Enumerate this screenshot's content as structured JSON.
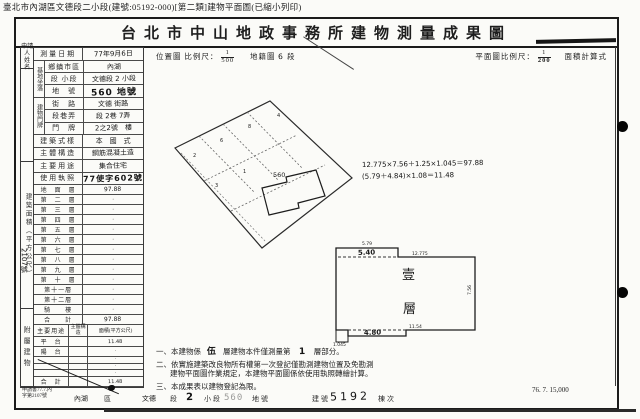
{
  "file_header": "臺北市內湖區文德段二小段(建號:05192-000)[第二類]建物平面圖(已縮小列印)",
  "title": "台北市中山地政事務所建物測量成果圖",
  "left_form": {
    "applicant_line1": "申請人",
    "applicant_line2": "姓 名",
    "building_area_axis": "建築面積（平方公尺）",
    "annex_axis": "附屬建物",
    "serial_hand": "2107號",
    "survey": {
      "label": "測量日期",
      "value": "77年9月6日"
    },
    "site": {
      "axis": "基地坐落",
      "rows": [
        {
          "label": "鄉鎮市區",
          "value": "內湖"
        },
        {
          "label": "段 小段",
          "value": "文德段 2 小段"
        },
        {
          "label": "地　號",
          "value": "560 地號"
        }
      ]
    },
    "address": {
      "axis": "建物門牌",
      "rows": [
        {
          "label": "街　路",
          "value": "文德 街路"
        },
        {
          "label": "段巷弄",
          "value": "段 2巷 7弄"
        },
        {
          "label": "門　牌",
          "value": "2之2號　樓"
        }
      ]
    },
    "style": {
      "label": "建築式樣",
      "value": "本　國　式"
    },
    "structure": {
      "label": "主體構造",
      "value": "鋼筋混凝土造"
    },
    "usage": {
      "label": "主要用途",
      "value": "集合住宅"
    },
    "license": {
      "label": "使用執照",
      "value": "77使字602號"
    },
    "floors": [
      {
        "label": "地　面　層",
        "value": "97.88"
      },
      {
        "label": "第　二　層",
        "value": "·"
      },
      {
        "label": "第　三　層",
        "value": "·"
      },
      {
        "label": "第　四　層",
        "value": "·"
      },
      {
        "label": "第　五　層",
        "value": "·"
      },
      {
        "label": "第　六　層",
        "value": "·"
      },
      {
        "label": "第　七　層",
        "value": "·"
      },
      {
        "label": "第　八　層",
        "value": "·"
      },
      {
        "label": "第　九　層",
        "value": "·"
      },
      {
        "label": "第　十　層",
        "value": "·"
      },
      {
        "label": "第十一層",
        "value": "·"
      },
      {
        "label": "第十二層",
        "value": "·"
      },
      {
        "label": "騎　　樓",
        "value": "·"
      },
      {
        "label": "合　　計",
        "value": "97.88"
      }
    ],
    "annex": {
      "headers": [
        "主要用途",
        "主體構造",
        "面積(平方公尺)"
      ],
      "rows": [
        {
          "use": "平　台",
          "area": "11.48"
        },
        {
          "use": "陽　台",
          "area": "·"
        },
        {
          "use": "",
          "area": "·"
        },
        {
          "use": "",
          "area": "·"
        },
        {
          "use": "",
          "area": "·"
        }
      ],
      "total_label": "合　計",
      "total": "11.48"
    },
    "application_line1": "申請書77.7.內",
    "application_line2": "字第2107號"
  },
  "map": {
    "location_label": "位置圖 比例尺：",
    "location_num": "1",
    "location_den": "500",
    "cadastral_label": "地籍圖",
    "cadastral_hand": "6",
    "cadastral_suffix": "段",
    "plan_label": "平面圖比例尺：",
    "plan_num": "1",
    "plan_den": "200",
    "calc_label": "面積計算式",
    "formula_main": "12.775×7.56＋1.25×1.045＝97.88",
    "formula_annex": "(5.79＋4.84)×1.08＝11.48",
    "parcel_number": "560",
    "floor_char_top": "壹",
    "floor_char_bottom": "層",
    "parcel_digits": [
      "2",
      "6",
      "8",
      "4",
      "3",
      "1"
    ],
    "dims": {
      "top_balcony": "5.40",
      "top_balcony_small": "5.79",
      "top_edge": "12.775",
      "right_edge": "7.56",
      "bottom_balcony": "4.80",
      "corner": "1.045",
      "bottom_edge": "11.54"
    }
  },
  "notes": {
    "n1_pre": "一、本建物係",
    "n1_hand1": "伍",
    "n1_mid": "層建物本件僅測量第",
    "n1_hand2": "1",
    "n1_suf": "層部分。",
    "n2_line1": "二、依實施建築改良物所有權第一次登記僅勘測建物位置及免勘測",
    "n2_line2": "建物平面圖作業規定，本建物平面圖係依使用執照轉繪計算。",
    "n3": "三、本成果表以建物登記為限。"
  },
  "footer": {
    "district": "內湖",
    "district_label": "區",
    "section": "文德",
    "section_label": "段",
    "subsection": "2",
    "subsection_label": "小段",
    "parcel": "560",
    "parcel_label": "地號",
    "building_label": "建號",
    "building": "5192",
    "unit_label": "棟次",
    "print_info": "76. 7. 15,000"
  }
}
